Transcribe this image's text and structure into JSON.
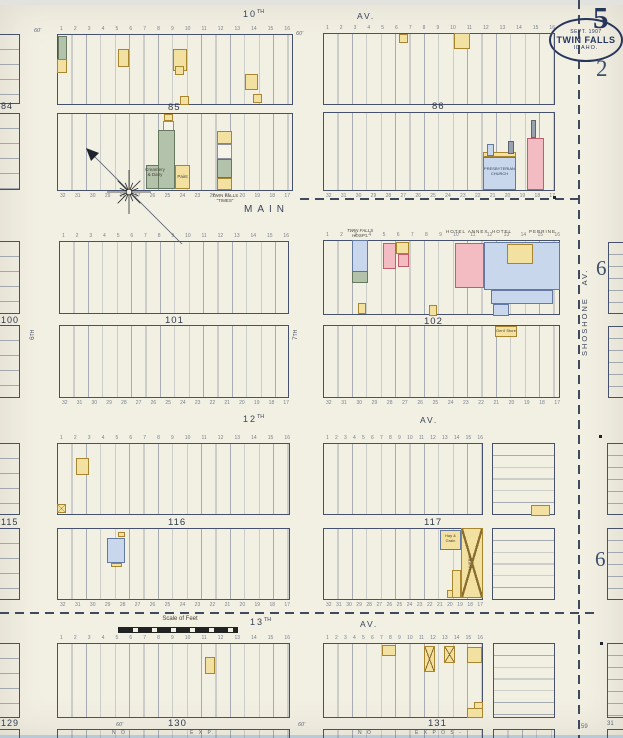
{
  "sheet": {
    "big_number": "5",
    "small_number": "2",
    "block6_upper": "6",
    "block6_lower": "6",
    "num59": "59",
    "num31": "31"
  },
  "stamp": {
    "date": "SEPT. 1907",
    "city": "TWIN FALLS",
    "state": "IDAHO."
  },
  "streets": {
    "tenth_num": "10",
    "tenth_ord": "TH",
    "tenth_av": "AV.",
    "main": "MAIN",
    "twelfth_num": "12",
    "twelfth_ord": "TH",
    "twelfth_av": "AV.",
    "thirteenth_num": "13",
    "thirteenth_ord": "TH",
    "thirteenth_av": "AV.",
    "shoshone": "SHOSHONE AV.",
    "sixth_num": "6",
    "sixth_ord": "TH",
    "seventh_num": "7",
    "seventh_ord": "TH"
  },
  "blocks": {
    "b84": "84",
    "b85": "85",
    "b86": "86",
    "b100": "100",
    "b101": "101",
    "b102": "102",
    "b115": "115",
    "b116": "116",
    "b117": "117",
    "b129": "129",
    "b130": "130",
    "b131": "131"
  },
  "buildings": {
    "creamery_l1": "Creamery",
    "creamery_l2": "& Dairy",
    "paint": "Paint",
    "times_l1": "TWIN FALLS",
    "times_l2": "“TIMES”",
    "church_l1": "PRESBYTERIAN",
    "church_l2": "CHURCH",
    "hosp_l1": "TWIN FALLS",
    "hosp_l2": "HOSP'L",
    "hotel_annex": "HOTEL ANNEX",
    "hotel_perrine": "HOTEL PERRINE",
    "livery": "LIVERY",
    "hay_l1": "Hay &",
    "hay_l2": "Grain",
    "store": "Gen'l Store"
  },
  "scale": {
    "label": "Scale of Feet"
  },
  "strips": {
    "no_left": "N O",
    "exp_left": "E X P.",
    "no_right": "N O",
    "expos_right": "E X P O S -"
  },
  "annotations": {
    "sixty": "60'"
  },
  "lots": {
    "top": "1 2 3 4 5 6 7 8 9 10 11 12 13 14 15 16",
    "bottom": "32 31 30 29 28 27 26 25 24 23 22 21 20 19 18 17"
  },
  "colors": {
    "paper": "#f2efe3",
    "ink": "#39445a",
    "yellow": "#f3e1a2",
    "pink": "#f3bcc2",
    "blue": "#c9d7ec",
    "green": "#b3c3ab"
  }
}
